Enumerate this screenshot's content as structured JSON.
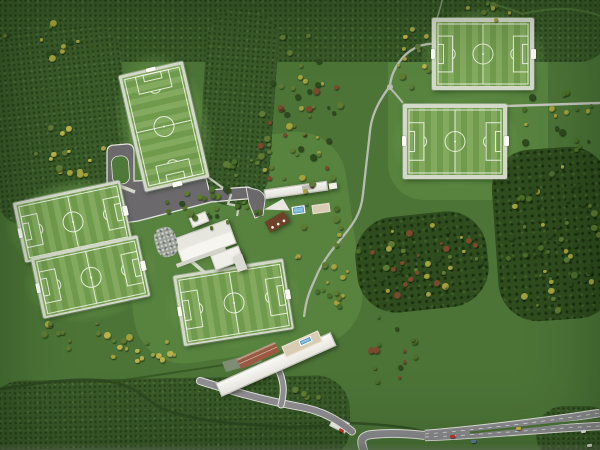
{
  "meta": {
    "description": "Aerial view of an architectural scale model of a football training centre: six pitches on terraced plateaus, clubhouse cluster, pavilion with pool, long residence building with rooftop pool, parking loop, winding footpaths, tree-covered slopes and a motorway along the bottom edge.",
    "image_type": "photograph-of-model"
  },
  "palette": {
    "base": "#4c7437",
    "rough": "#3a5a29",
    "forest": "#2f4c1e",
    "lawn": "#57833f",
    "apron": "#68964a",
    "pitch": "#79a352",
    "line": "#f0f4e8",
    "walkway": "#d3d8c9",
    "asphalt": "#6b696c",
    "curb": "#e6e6df",
    "road": "#8f8e92",
    "roadEdge": "#e9e9e3",
    "trail": "#b7bbb0",
    "hedge": "#2c4820",
    "hedgeLight": "#53793b",
    "building": "#f0efe9",
    "buildingShade": "#dcdbd3",
    "roofRed": "#9a5a41",
    "roofBrown": "#6e4128",
    "pool": "#5a95c2",
    "poolLight": "#8cc0de",
    "terrace": "#d8cdb4",
    "gravel": "#9aa096",
    "carRed": "#c23b2e",
    "carYellow": "#d8b43a",
    "carBlue": "#5a7fb4",
    "carWhite": "#f2f2f0"
  },
  "pitches": [
    {
      "id": "pitch-top-left",
      "cx": 164,
      "cy": 126,
      "w": 60,
      "h": 113,
      "rot": -13,
      "orient": "portrait",
      "pad": 3,
      "apron": [
        18,
        20
      ]
    },
    {
      "id": "pitch-west-upper",
      "cx": 72,
      "cy": 221,
      "w": 104,
      "h": 56,
      "rot": -12,
      "orient": "landscape",
      "pad": 2.5,
      "apron": [
        16,
        14
      ]
    },
    {
      "id": "pitch-west-lower",
      "cx": 90,
      "cy": 277,
      "w": 104,
      "h": 57,
      "rot": -12,
      "orient": "landscape",
      "pad": 2.5,
      "apron": [
        16,
        16
      ]
    },
    {
      "id": "pitch-center",
      "cx": 233,
      "cy": 302,
      "w": 106,
      "h": 66,
      "rot": -9,
      "orient": "landscape",
      "pad": 2.5,
      "apron": [
        16,
        14
      ]
    },
    {
      "id": "pitch-northeast",
      "cx": 483,
      "cy": 54,
      "w": 94,
      "h": 64,
      "rot": 0,
      "orient": "landscape",
      "pad": 4,
      "apron": [
        17,
        15
      ]
    },
    {
      "id": "pitch-east",
      "cx": 455,
      "cy": 141,
      "w": 96,
      "h": 67,
      "rot": 0,
      "orient": "landscape",
      "pad": 4,
      "apron": [
        17,
        14
      ]
    }
  ],
  "buildings": {
    "clubhouse": {
      "label": "Clubhouse (hipped roofs)"
    },
    "clubhouseWing": {
      "label": "Clubhouse east wing"
    },
    "clubhousePavilion": {
      "label": "Small pavilion"
    },
    "canopy": {
      "label": "Covered walkway"
    },
    "gravelGarden": {
      "label": "Gravel garden"
    },
    "northPavilion": {
      "label": "North pavilion"
    },
    "northAnnex": {
      "label": "Timber annex with skylights"
    },
    "northPool": {
      "label": "Outdoor pool"
    },
    "northTerrace": {
      "label": "Terrace"
    },
    "hut": {
      "label": "Small hut"
    },
    "southResidence": {
      "label": "Long residence building"
    },
    "southRedRoof": {
      "label": "Red tiled roof section"
    },
    "southTerrace": {
      "label": "Rooftop terrace"
    },
    "southPool": {
      "label": "Rooftop pool"
    }
  },
  "roads": {
    "parking": {
      "label": "Parking loop and car park"
    },
    "access": {
      "label": "Access lane to pavilion"
    },
    "steps": {
      "label": "Stepped walkway"
    },
    "trail": {
      "label": "Winding footpath"
    },
    "trailEast": {
      "label": "Footpath to east edge"
    },
    "southRoad": {
      "label": "Service road"
    },
    "driveway": {
      "label": "Residence driveway"
    },
    "bridge": {
      "label": "Small bridge"
    },
    "motorway": {
      "label": "Motorway (dual carriageway)"
    }
  },
  "cars": [
    {
      "x": 341,
      "y": 430,
      "rot": 28,
      "color": "carRed"
    },
    {
      "x": 452,
      "y": 436,
      "rot": -5,
      "color": "carRed"
    },
    {
      "x": 518,
      "y": 428,
      "rot": -6,
      "color": "carYellow"
    },
    {
      "x": 473,
      "y": 441,
      "rot": -4,
      "color": "carBlue"
    },
    {
      "x": 583,
      "y": 431,
      "rot": -8,
      "color": "carWhite"
    },
    {
      "x": 589,
      "y": 445,
      "rot": -7,
      "color": "carWhite"
    }
  ],
  "tree_clusters": [
    {
      "cx": 300,
      "cy": 118,
      "rx": 46,
      "ry": 88,
      "n": 58,
      "colors": [
        "#5f7a33",
        "#a3a13e",
        "#7b4a2c",
        "#2f4a1e"
      ]
    },
    {
      "cx": 48,
      "cy": 40,
      "rx": 45,
      "ry": 20,
      "n": 12,
      "colors": [
        "#5f7a33",
        "#2f4a1e",
        "#a3a13e"
      ]
    },
    {
      "cx": 70,
      "cy": 145,
      "rx": 42,
      "ry": 36,
      "n": 16,
      "colors": [
        "#a3a13e",
        "#5f7a33",
        "#b9b24a"
      ]
    },
    {
      "cx": 212,
      "cy": 209,
      "rx": 48,
      "ry": 21,
      "n": 26,
      "colors": [
        "#4c6e2a",
        "#5f7a33",
        "#2f4a1e"
      ]
    },
    {
      "cx": 330,
      "cy": 255,
      "rx": 36,
      "ry": 54,
      "n": 22,
      "colors": [
        "#5f7a33",
        "#a3a13e",
        "#4c6e2a"
      ]
    },
    {
      "cx": 424,
      "cy": 262,
      "rx": 58,
      "ry": 42,
      "n": 46,
      "colors": [
        "#2f4a1e",
        "#7b4a2c",
        "#5f7a33",
        "#a3a13e"
      ]
    },
    {
      "cx": 552,
      "cy": 238,
      "rx": 50,
      "ry": 74,
      "n": 54,
      "colors": [
        "#2f4a1e",
        "#4c6e2a",
        "#a3a13e",
        "#5f7a33"
      ]
    },
    {
      "cx": 137,
      "cy": 347,
      "rx": 42,
      "ry": 18,
      "n": 18,
      "colors": [
        "#a3a13e",
        "#5f7a33",
        "#b9b24a"
      ]
    },
    {
      "cx": 70,
      "cy": 333,
      "rx": 36,
      "ry": 16,
      "n": 10,
      "colors": [
        "#5f7a33",
        "#a3a13e"
      ]
    },
    {
      "cx": 414,
      "cy": 60,
      "rx": 19,
      "ry": 42,
      "n": 12,
      "colors": [
        "#a3a13e",
        "#5f7a33",
        "#b9b24a"
      ]
    },
    {
      "cx": 558,
      "cy": 125,
      "rx": 40,
      "ry": 36,
      "n": 18,
      "colors": [
        "#4c6e2a",
        "#2f4a1e",
        "#a3a13e"
      ]
    },
    {
      "cx": 382,
      "cy": 350,
      "rx": 38,
      "ry": 36,
      "n": 14,
      "colors": [
        "#4c6e2a",
        "#2f4a1e",
        "#7b4a2c"
      ]
    },
    {
      "cx": 490,
      "cy": 12,
      "rx": 44,
      "ry": 9,
      "n": 8,
      "colors": [
        "#a3a13e",
        "#5f7a33"
      ]
    },
    {
      "cx": 310,
      "cy": 393,
      "rx": 16,
      "ry": 9,
      "n": 5,
      "colors": [
        "#5f7a33",
        "#4c6e2a"
      ]
    },
    {
      "cx": 243,
      "cy": 170,
      "rx": 28,
      "ry": 11,
      "n": 10,
      "colors": [
        "#5f7a33",
        "#4c6e2a",
        "#a3a13e"
      ]
    }
  ]
}
